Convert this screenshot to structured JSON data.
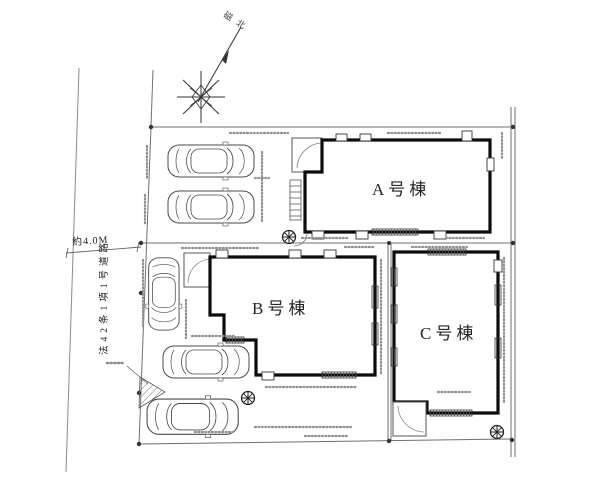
{
  "plan": {
    "compass": {
      "label": "磁北"
    },
    "road": {
      "width_label": "約4.0M",
      "name_label": "法42条1項1号道路"
    },
    "buildings": [
      {
        "id": "A",
        "label": "A号棟"
      },
      {
        "id": "B",
        "label": "B号棟"
      },
      {
        "id": "C",
        "label": "C号棟"
      }
    ]
  }
}
